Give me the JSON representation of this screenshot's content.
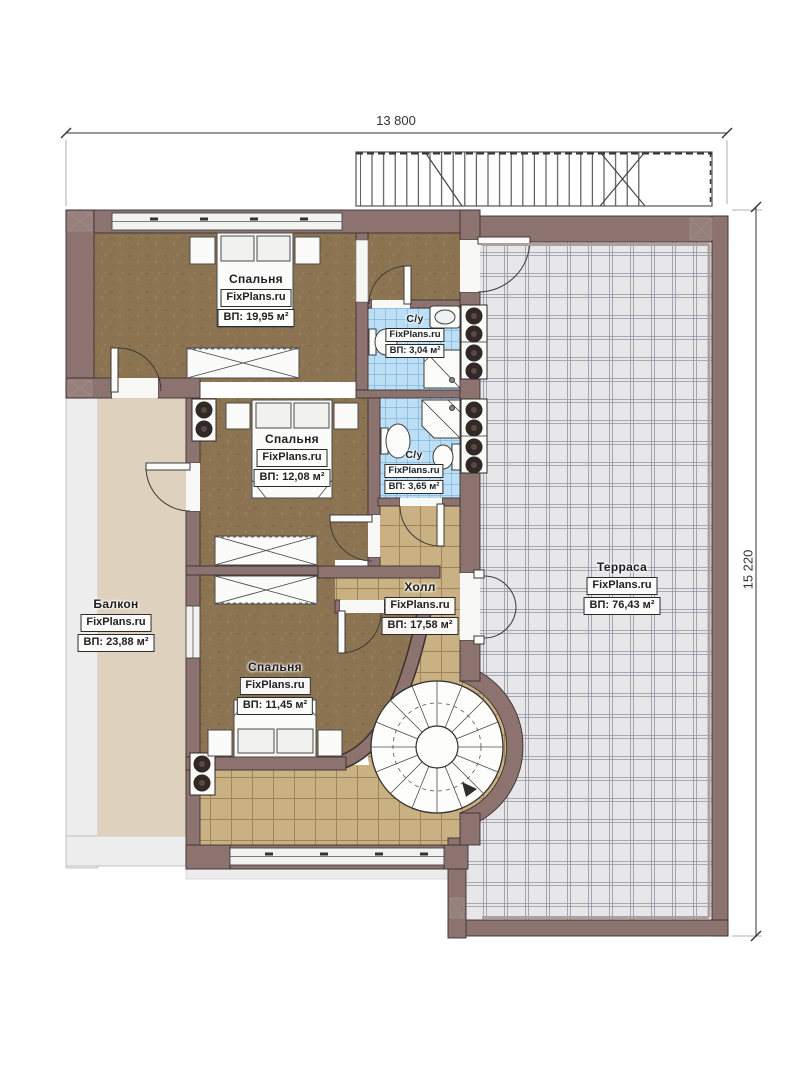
{
  "plan": {
    "type": "floor-plan-second-storey",
    "watermark": "FixPlans.ru",
    "dimensions": {
      "width_label": "13 800",
      "height_label": "15 220"
    },
    "rooms": [
      {
        "id": "bedroom-1",
        "name": "Спальня",
        "watermark": "FixPlans.ru",
        "area": "ВП: 19,95 м²"
      },
      {
        "id": "bathroom-1",
        "name": "С/у",
        "watermark": "FixPlans.ru",
        "area": "ВП: 3,04 м²"
      },
      {
        "id": "bedroom-2",
        "name": "Спальня",
        "watermark": "FixPlans.ru",
        "area": "ВП: 12,08 м²"
      },
      {
        "id": "bathroom-2",
        "name": "С/у",
        "watermark": "FixPlans.ru",
        "area": "ВП: 3,65 м²"
      },
      {
        "id": "balcony",
        "name": "Балкон",
        "watermark": "FixPlans.ru",
        "area": "ВП: 23,88 м²"
      },
      {
        "id": "hall",
        "name": "Холл",
        "watermark": "FixPlans.ru",
        "area": "ВП: 17,58 м²"
      },
      {
        "id": "bedroom-3",
        "name": "Спальня",
        "watermark": "FixPlans.ru",
        "area": "ВП: 11,45 м²"
      },
      {
        "id": "terrace",
        "name": "Терраса",
        "watermark": "FixPlans.ru",
        "area": "ВП: 76,43 м²"
      }
    ],
    "colors": {
      "wall": "#8c7370",
      "wall_edge": "#3c3130",
      "bedroom_floor": "#8c7453",
      "hall_floor": "#c9b183",
      "bath_floor": "#bcdff5",
      "balcony_floor": "#ded1be",
      "terrace_floor": "#e7e7ea",
      "slab": "#ededed"
    }
  }
}
